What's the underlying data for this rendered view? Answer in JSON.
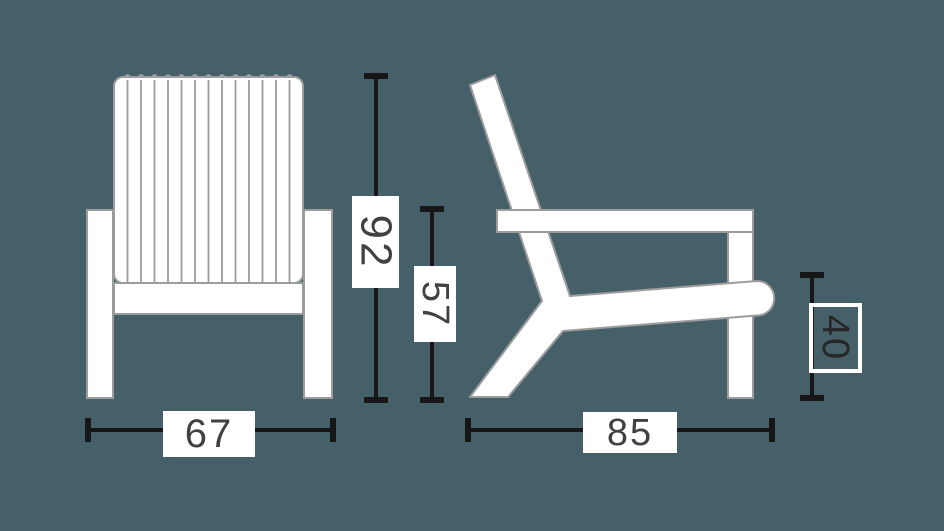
{
  "diagram": {
    "type": "furniture-dimension-drawing",
    "subject": "adirondack-lounge-chair",
    "views": [
      {
        "id": "front-view",
        "position": "left"
      },
      {
        "id": "side-view",
        "position": "right"
      }
    ],
    "colors": {
      "background": "#46606a",
      "chair_fill": "#ffffff",
      "chair_outline": "#9c9c9c",
      "dimension_line": "#171717",
      "label_background": "#ffffff",
      "label_text": "#414141",
      "outlined_label_border": "#ffffff",
      "outlined_label_text": "#262626"
    },
    "dimensions": {
      "overall_height": {
        "value": "92",
        "orientation": "vertical",
        "label_style": "filled",
        "view": "front"
      },
      "armrest_height": {
        "value": "57",
        "orientation": "vertical",
        "label_style": "filled",
        "view": "front"
      },
      "overall_width": {
        "value": "67",
        "orientation": "horizontal",
        "label_style": "filled",
        "view": "front"
      },
      "overall_depth": {
        "value": "85",
        "orientation": "horizontal",
        "label_style": "filled",
        "view": "side"
      },
      "seat_height": {
        "value": "40",
        "orientation": "vertical",
        "label_style": "outlined",
        "view": "side"
      }
    }
  }
}
